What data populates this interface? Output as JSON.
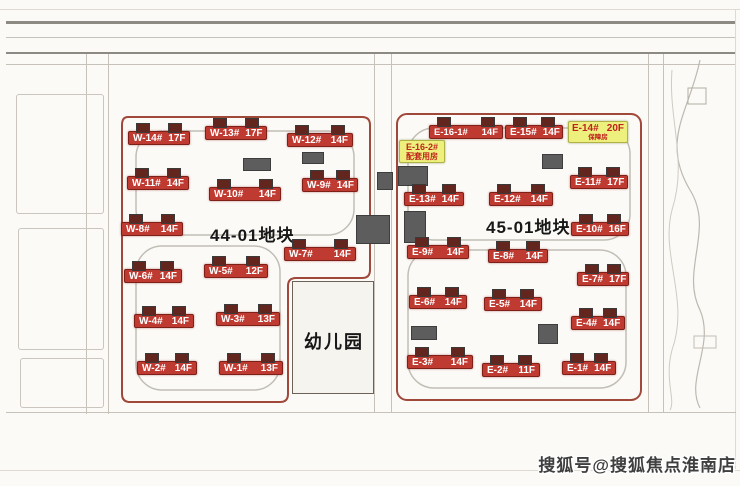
{
  "watermark": "搜狐号@搜狐焦点淮南店",
  "kindergarten_label": "幼儿园",
  "colors": {
    "label_red": "#bf3a31",
    "label_yellow": "#edf07c",
    "boundary_red": "#a0493b"
  },
  "plots": [
    {
      "title": "44-01地块",
      "buildings": [
        {
          "name": "W-14#",
          "floors": "17F"
        },
        {
          "name": "W-13#",
          "floors": "17F"
        },
        {
          "name": "W-12#",
          "floors": "14F"
        },
        {
          "name": "W-11#",
          "floors": "14F"
        },
        {
          "name": "W-10#",
          "floors": "14F"
        },
        {
          "name": "W-9#",
          "floors": "14F"
        },
        {
          "name": "W-8#",
          "floors": "14F"
        },
        {
          "name": "W-7#",
          "floors": "14F"
        },
        {
          "name": "W-6#",
          "floors": "14F"
        },
        {
          "name": "W-5#",
          "floors": "12F"
        },
        {
          "name": "W-4#",
          "floors": "14F"
        },
        {
          "name": "W-3#",
          "floors": "13F"
        },
        {
          "name": "W-2#",
          "floors": "14F"
        },
        {
          "name": "W-1#",
          "floors": "13F"
        }
      ]
    },
    {
      "title": "45-01地块",
      "buildings": [
        {
          "name": "E-16-1#",
          "floors": "14F"
        },
        {
          "name": "E-15#",
          "floors": "14F"
        },
        {
          "name": "E-13#",
          "floors": "14F"
        },
        {
          "name": "E-12#",
          "floors": "14F"
        },
        {
          "name": "E-11#",
          "floors": "17F"
        },
        {
          "name": "E-10#",
          "floors": "16F"
        },
        {
          "name": "E-9#",
          "floors": "14F"
        },
        {
          "name": "E-8#",
          "floors": "14F"
        },
        {
          "name": "E-7#",
          "floors": "17F"
        },
        {
          "name": "E-6#",
          "floors": "14F"
        },
        {
          "name": "E-5#",
          "floors": "14F"
        },
        {
          "name": "E-4#",
          "floors": "14F"
        },
        {
          "name": "E-3#",
          "floors": "14F"
        },
        {
          "name": "E-2#",
          "floors": "11F"
        },
        {
          "name": "E-1#",
          "floors": "14F"
        }
      ],
      "special": [
        {
          "name": "E-14#",
          "floors": "20F",
          "note": "保障房"
        },
        {
          "name": "E-16-2#",
          "note": "配套用房"
        }
      ]
    }
  ]
}
